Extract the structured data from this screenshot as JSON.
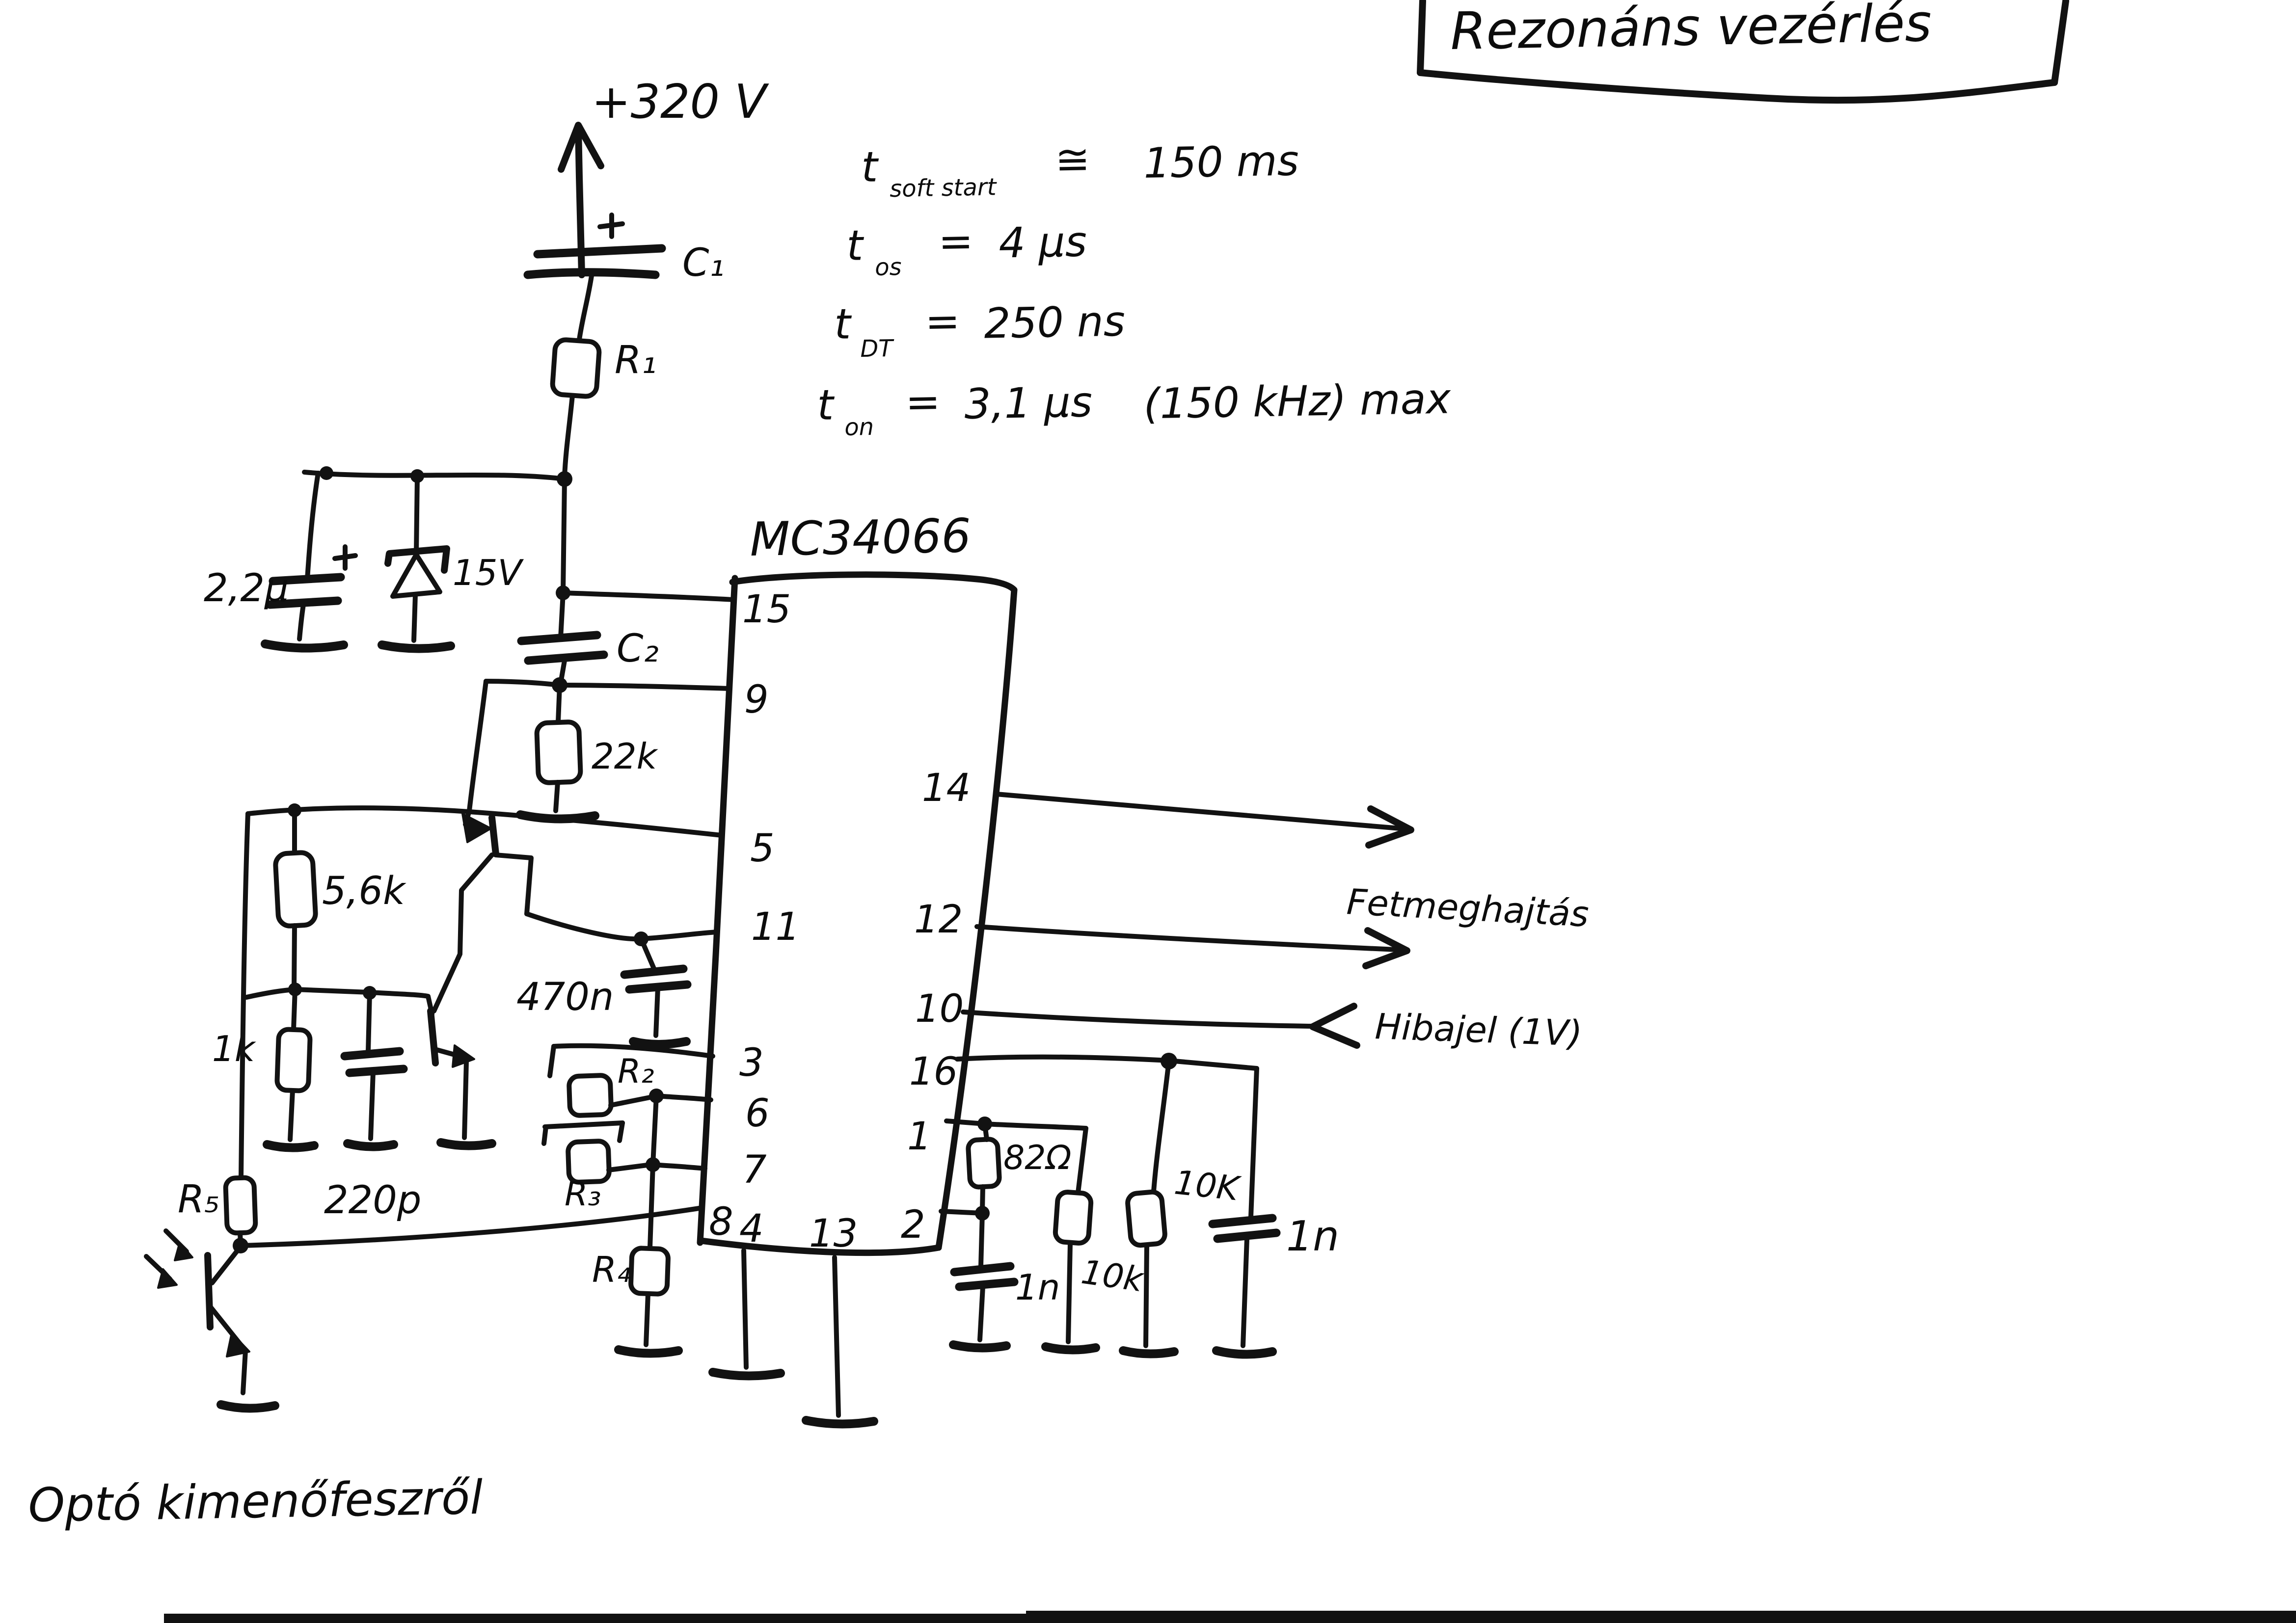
{
  "title": "Rezonáns vezérlés",
  "notes": {
    "n1": {
      "sym": "t",
      "sub": "soft start",
      "op": "≅",
      "val": "150 ms"
    },
    "n2": {
      "sym": "t",
      "sub": "os",
      "op": "=",
      "val": "4 μs"
    },
    "n3": {
      "sym": "t",
      "sub": "DT",
      "op": "=",
      "val": "250 ns"
    },
    "n4": {
      "sym": "t",
      "sub": "on",
      "op": "=",
      "val": "3,1 μs",
      "extra": "(150 kHz) max"
    }
  },
  "power": {
    "rail": "+320 V"
  },
  "ic": {
    "name": "MC34066",
    "pins_left": [
      "15",
      "9",
      "5",
      "11",
      "3",
      "6",
      "7",
      "8"
    ],
    "pins_bottom": [
      "4",
      "13",
      "2"
    ],
    "pins_right": [
      "14",
      "12",
      "10",
      "16",
      "1"
    ]
  },
  "comp": {
    "c1": "C₁",
    "r1": "R₁",
    "c_2u2": "2,2μ",
    "zener": "15V",
    "c2": "C₂",
    "r22k": "22k",
    "r56k": "5,6k",
    "r1k": "1k",
    "c220p": "220p",
    "r5": "R₅",
    "c470n": "470n",
    "r2": "R₂",
    "r3": "R₃",
    "r4": "R₄",
    "r82": "82Ω",
    "c1n_a": "1n",
    "r10k_a": "10k",
    "r10k_b": "10K",
    "c1n_b": "1n"
  },
  "labels": {
    "fet": "Fetmeghajtás",
    "hibajel": "Hibajel (1V)",
    "opto": "Optó kimenőfeszről"
  },
  "colors": {
    "ink": "#121212",
    "paper": "#ffffff"
  }
}
